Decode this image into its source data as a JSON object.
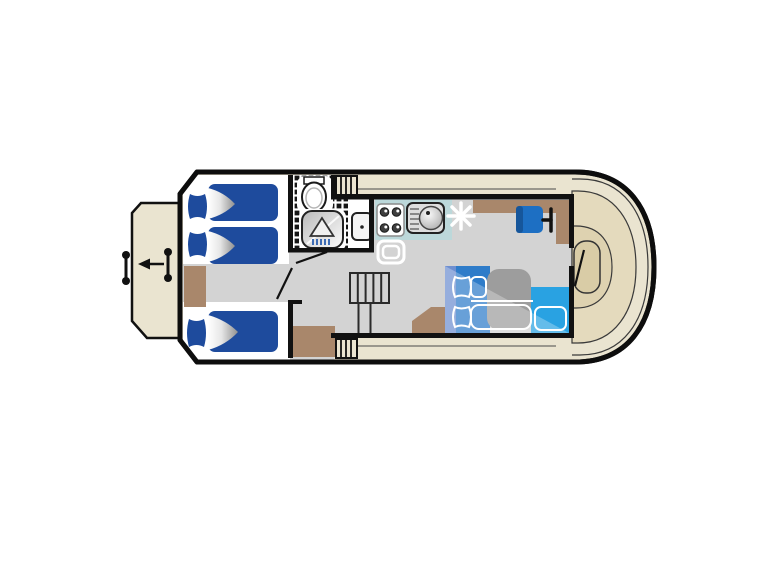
{
  "plan": {
    "vessel": "houseboat-deck-plan",
    "areas": [
      {
        "name": "stern-swim-platform",
        "features": [
          "mooring-bollard-outer",
          "mooring-bollard-inner",
          "exit-arrow-left"
        ]
      },
      {
        "name": "aft-cabin",
        "features": [
          "single-bed-top",
          "single-bed-middle",
          "single-bed-bottom",
          "wardrobe",
          "cabin-door",
          "lower-cabin-wall"
        ]
      },
      {
        "name": "bathroom",
        "features": [
          "toilet",
          "shower-tray",
          "shower-head-symbol",
          "washbasin",
          "tiled-floor",
          "bathroom-door"
        ]
      },
      {
        "name": "galley",
        "features": [
          "worktop",
          "four-burner-hob",
          "sink-with-drainer",
          "refrigerator-outline",
          "heater-asterisk",
          "side-counter"
        ]
      },
      {
        "name": "saloon-dinette",
        "features": [
          "backrest",
          "bench-seat",
          "seat-cushion-outlines",
          "pillow-outlines",
          "table",
          "side-bench-cyan",
          "convertible-double-bed-overlay",
          "corner-cabinet"
        ]
      },
      {
        "name": "helm",
        "features": [
          "helm-seat",
          "steering-wheel",
          "helm-console"
        ]
      },
      {
        "name": "companionway",
        "features": [
          "saloon-stairs",
          "top-deck-steps",
          "bottom-deck-steps"
        ]
      },
      {
        "name": "side-decks",
        "features": [
          "top-walkway",
          "bottom-walkway"
        ]
      },
      {
        "name": "bow-deck",
        "features": [
          "walkthrough-door",
          "deck-contour-lines",
          "bow-locker"
        ]
      }
    ]
  },
  "colors": {
    "hull": "#0d0d0d",
    "deck": "#eae4d0",
    "deck_inner1": "#e4dabd",
    "deck_inner2": "#ded2b0",
    "deck_inner3": "#d9cca6",
    "floor": "#d3d3d3",
    "white": "#ffffff",
    "wood": "#a9876b",
    "counter_teal": "#bcd8da",
    "bed_blue": "#1e4b9d",
    "seat_blue": "#2e7cc9",
    "backrest_blue": "#6e8fd0",
    "seat_cyan": "#29a2e2",
    "table_gray": "#9d9d9d",
    "helm_blue": "#1d6fc3",
    "helm_blue_dark": "#16569b",
    "shower_spray_blue": "#2b5fb0",
    "line_dark": "#3a3a3a"
  }
}
